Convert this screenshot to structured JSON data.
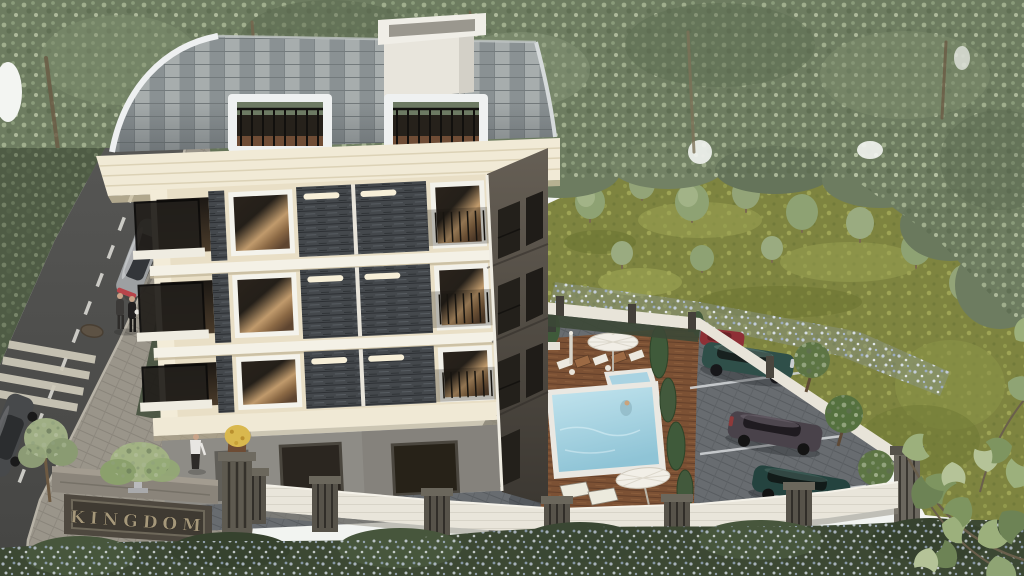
{
  "scene": {
    "sign": {
      "text": "KINGDOM"
    },
    "subject": "aerial 3d render of residential complex",
    "visible_objects": {
      "building": "four-storey cream apartment block, curved shingle roof, roof terraces, chimney",
      "amenities": [
        "swimming pool",
        "kids pool",
        "wooden sun deck",
        "sun loungers",
        "parasols",
        "parking lot"
      ],
      "street_cars": [
        "silver sedan driving",
        "dark gray car at lower-left edge"
      ],
      "parked_cars": [
        "red car",
        "teal suv",
        "gray suv",
        "dark teal car"
      ],
      "people": [
        "couple walking on sidewalk",
        "woman near entrance",
        "swimmer in pool"
      ]
    },
    "palette": {
      "foliage": "#6d7c60",
      "meadow": "#7e8440",
      "roof_shingle": "#99a0a1",
      "facade_cream": "#e9dfc6",
      "stone_cladding": "#44484c",
      "pool_water": "#9fd0e0",
      "deck_wood": "#7c5134",
      "asphalt": "#4e4e4c",
      "wall_white": "#e9e5da",
      "sign_panel": "#4e483f",
      "sign_letters": "#a6987a"
    }
  }
}
